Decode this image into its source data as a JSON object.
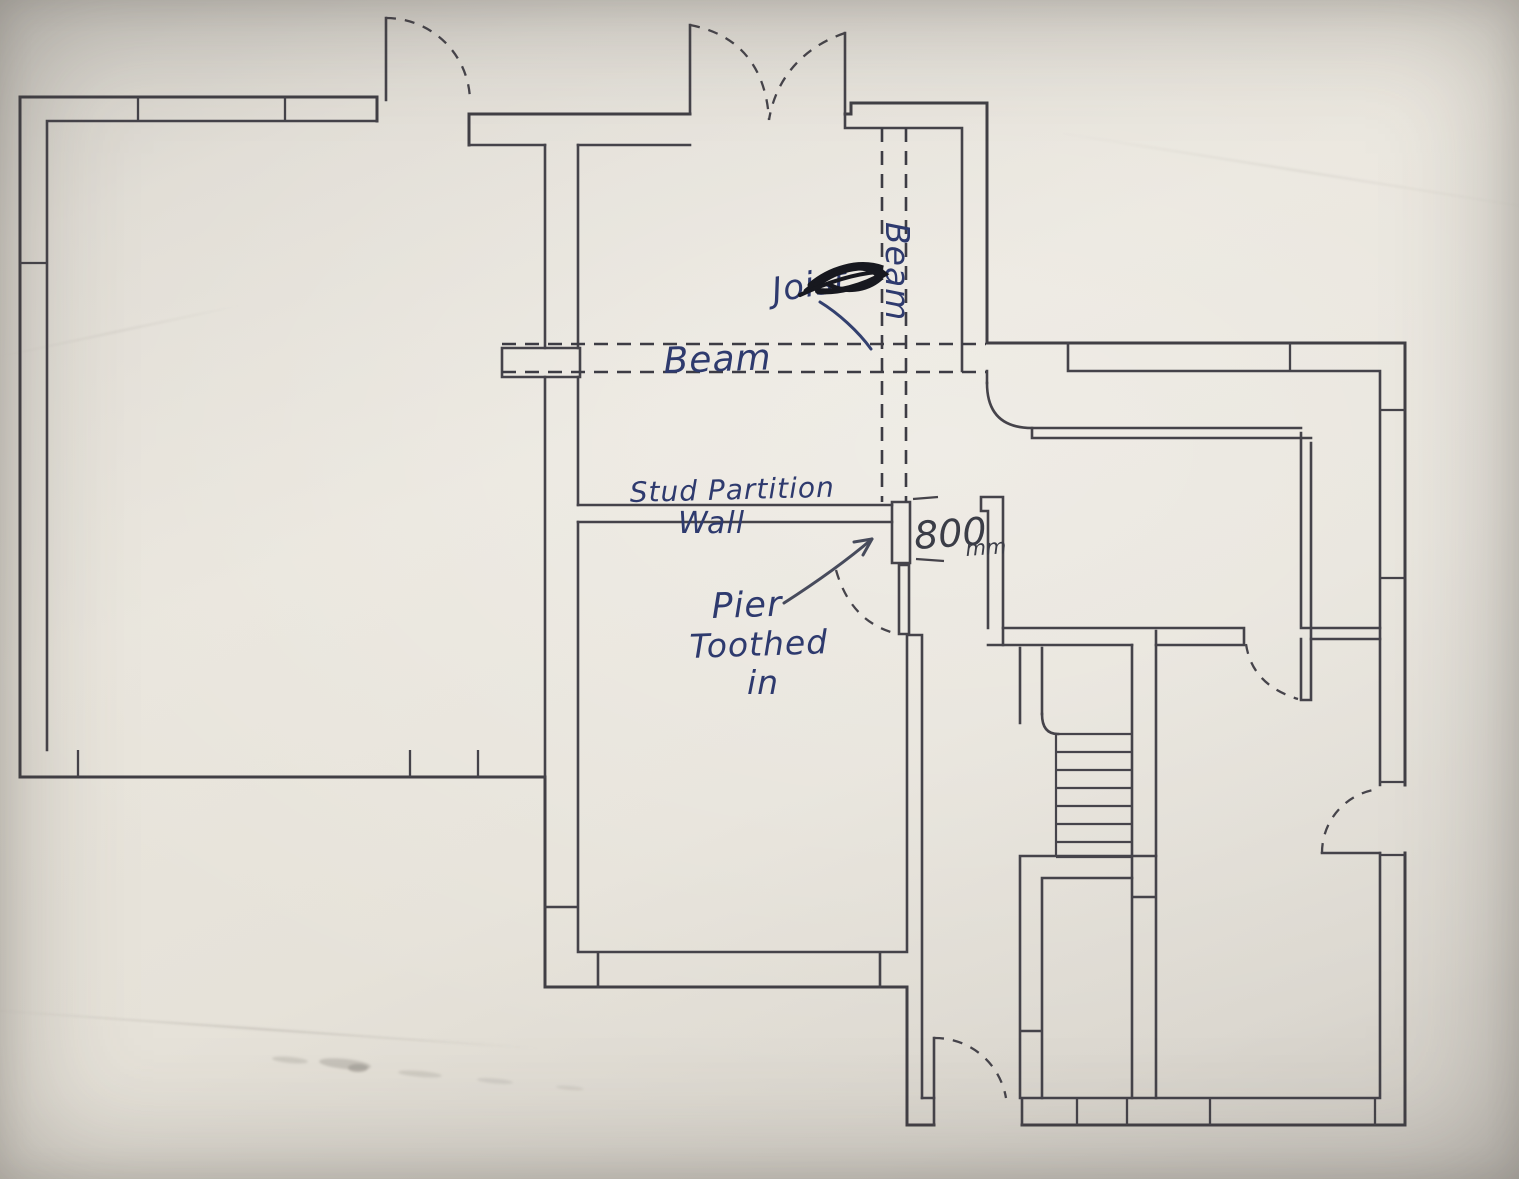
{
  "document": {
    "kind": "hand-annotated floor plan sketch (photograph of paper drawing)",
    "orientation": "landscape"
  },
  "labels": {
    "beam_horizontal": "Beam",
    "beam_vertical": "Beam",
    "joist_crossed_out": "Joist",
    "stud_partition_line1": "Stud Partition",
    "stud_partition_line2": "Wall",
    "dimension_value": "800",
    "dimension_unit": "mm",
    "pier_note_line1": "Pier",
    "pier_note_line2": "Toothed",
    "pier_note_line3": "in"
  },
  "plan_features": [
    "exterior cavity walls with window mullion ticks",
    "large room top-left",
    "knock-through opening spanned by dashed beam lines",
    "vertical dashed beam over opening (labelled Beam)",
    "joist note scribbled out in black ink",
    "stud partition wall",
    "pier toothed in at 800mm door opening",
    "door swing arcs (dashed quarter circles)",
    "double french doors at top centre",
    "staircase with seven treads",
    "small store room at bottom centre",
    "narrow hall strip room on right side"
  ],
  "colors": {
    "paper": "#e7e3da",
    "wall_line": "#413f45",
    "ink_blue": "#2e3a6e",
    "ink_black": "#17181f",
    "dimension_ink": "#3b3d47"
  }
}
